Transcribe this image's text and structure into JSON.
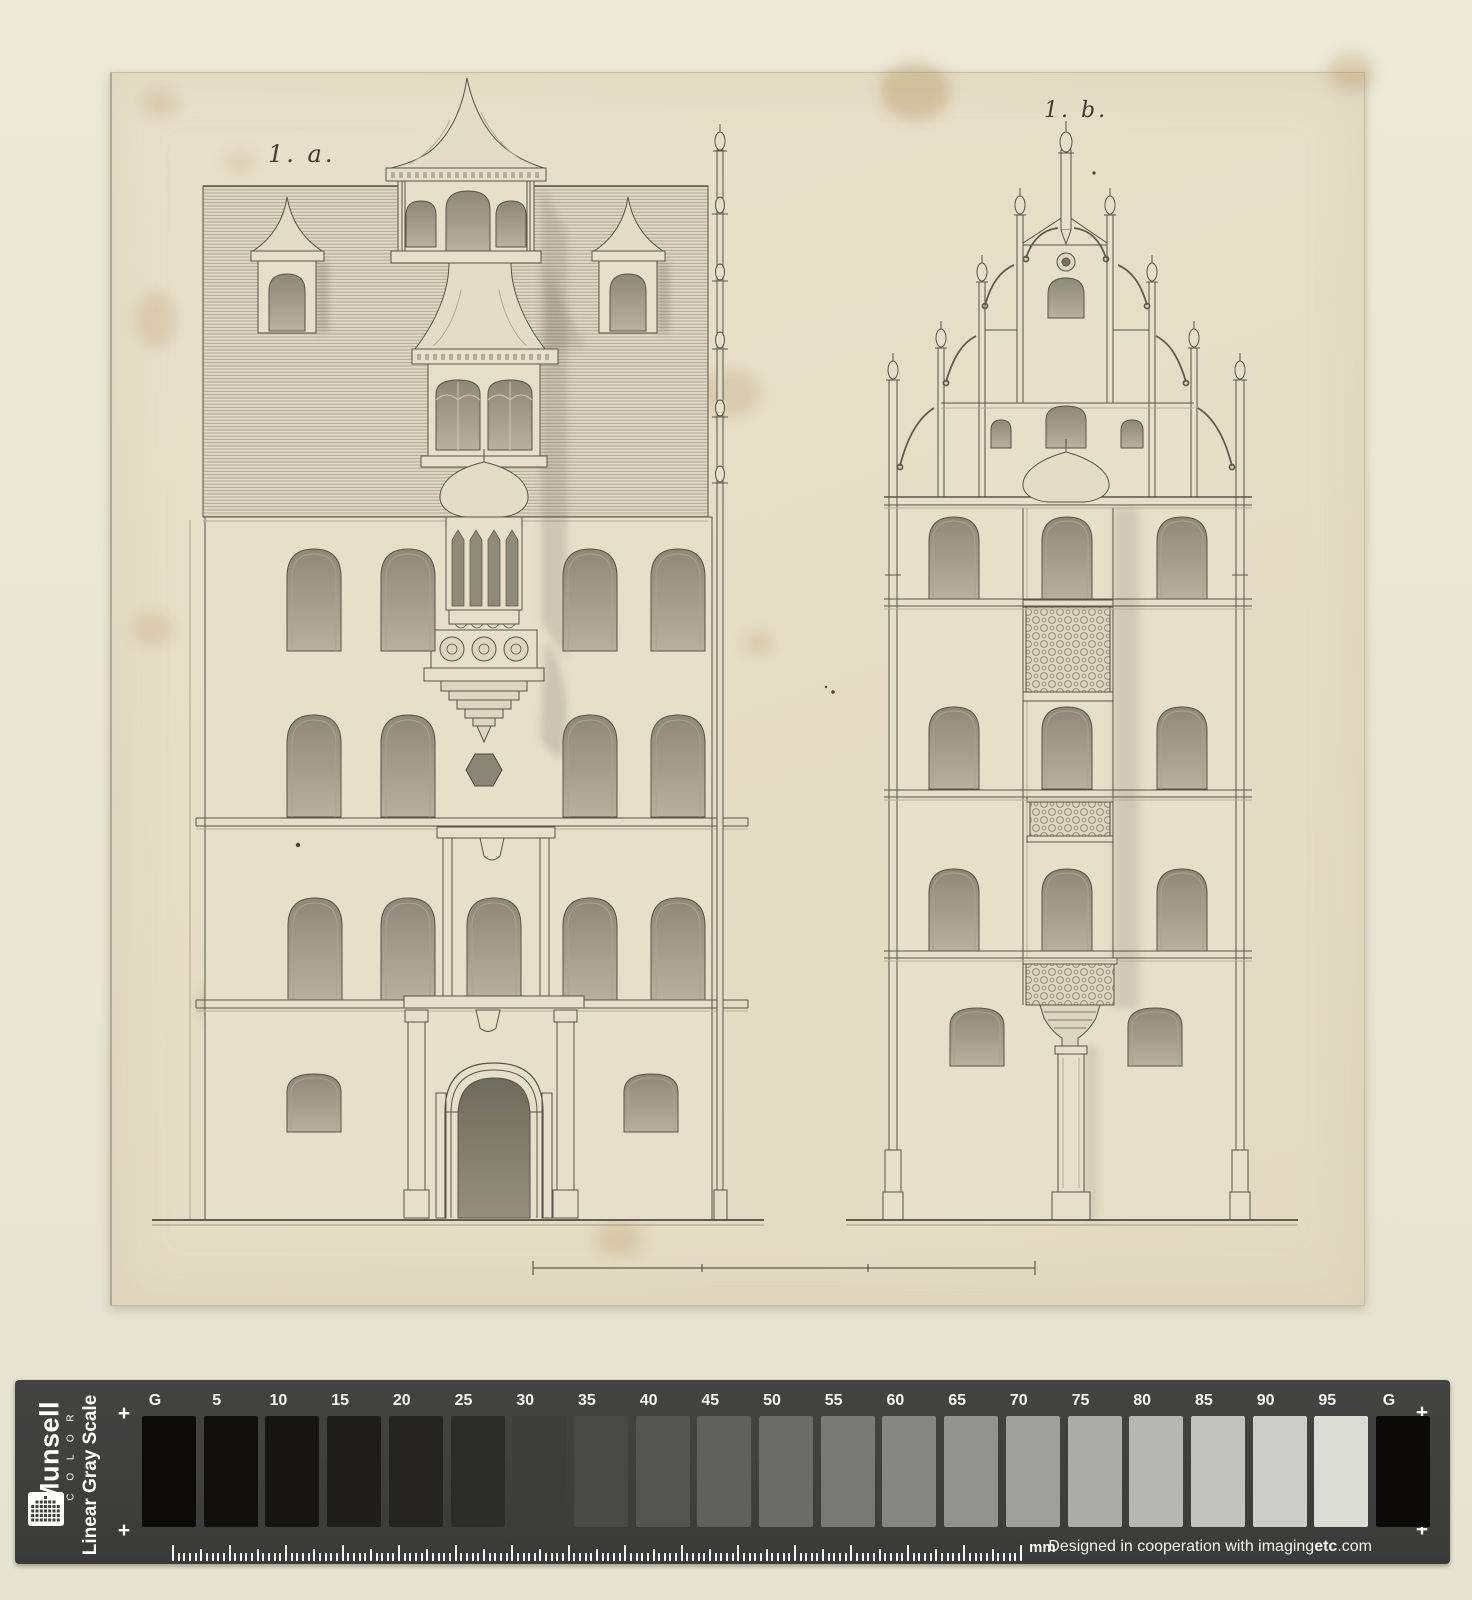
{
  "plate": {
    "figure_label_a": "1. a.",
    "figure_label_b": "1. b."
  },
  "calibration": {
    "brand": "Munsell",
    "brand_word": "C O L O R",
    "scale_title": "Linear Gray Scale",
    "ruler_unit": "mm",
    "registration_mark": "+",
    "credit": {
      "prefix": "Designed in cooperation with imaging",
      "bold": "etc",
      "suffix": ".com"
    },
    "icons": {
      "logo": "munsell-dot-grid-icon"
    },
    "patches": [
      {
        "label": "G",
        "hex": "#0c0b09"
      },
      {
        "label": "5",
        "hex": "#100f0d"
      },
      {
        "label": "10",
        "hex": "#161511"
      },
      {
        "label": "15",
        "hex": "#1e1d1a"
      },
      {
        "label": "20",
        "hex": "#252420"
      },
      {
        "label": "25",
        "hex": "#2c2c28"
      },
      {
        "label": "30",
        "hex": "#3c3d3a"
      },
      {
        "label": "35",
        "hex": "#484845"
      },
      {
        "label": "40",
        "hex": "#545451"
      },
      {
        "label": "45",
        "hex": "#60605d"
      },
      {
        "label": "50",
        "hex": "#6b6b68"
      },
      {
        "label": "55",
        "hex": "#787875"
      },
      {
        "label": "60",
        "hex": "#858582"
      },
      {
        "label": "65",
        "hex": "#92928f"
      },
      {
        "label": "70",
        "hex": "#9f9f9c"
      },
      {
        "label": "75",
        "hex": "#acaca9"
      },
      {
        "label": "80",
        "hex": "#b6b6b3"
      },
      {
        "label": "85",
        "hex": "#c1c1be"
      },
      {
        "label": "90",
        "hex": "#ccccc9"
      },
      {
        "label": "95",
        "hex": "#dcdcd7"
      },
      {
        "label": "G",
        "hex": "#0b0a08"
      }
    ]
  }
}
